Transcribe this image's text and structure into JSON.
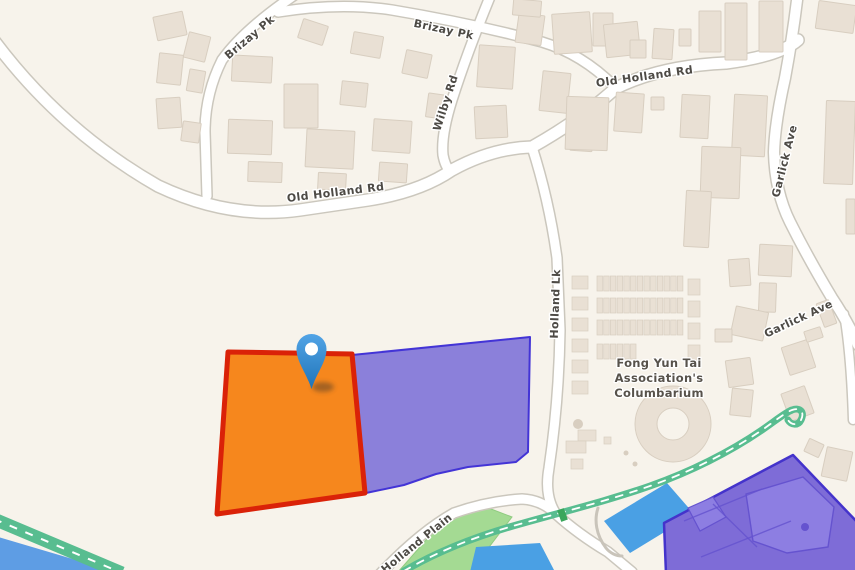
{
  "map": {
    "colors": {
      "bg": "#f7f3eb",
      "building_fill": "#e9e0d4",
      "building_stroke": "#d8cec0",
      "road_casing": "#cbc7bd",
      "road_fill": "#ffffff",
      "road_label": "#4d4a45",
      "poi_label": "#57524b",
      "park_fill": "#a4da93",
      "park_stroke": "#8fcb80",
      "water": "#5e9de4",
      "pond": "#4aa0e4",
      "path_green": "#58bd90",
      "path_dash": "#ffffff",
      "path_marker": "#3aa65c",
      "selected_fill": "#f6871d",
      "selected_stroke": "#da2208",
      "adjacent_fill": "#8b80da",
      "adjacent_stroke": "#4334d6",
      "estate_fill": "#7e6cd7",
      "estate_stroke": "#4433cb",
      "estate_inner_fill": "#8d7ee2",
      "estate_inner_line": "#6553cf",
      "pin_top": "#52a4e6",
      "pin_bottom": "#1f74b8",
      "pin_hole": "#ffffff",
      "wall_gray": "#c9c4ba"
    },
    "road_labels": [
      {
        "text": "Brizay Pk",
        "x": 252,
        "y": 40,
        "rotate": -40
      },
      {
        "text": "Brizay Pk",
        "x": 443,
        "y": 33,
        "rotate": 12
      },
      {
        "text": "Wilby Rd",
        "x": 449,
        "y": 104,
        "rotate": -72
      },
      {
        "text": "Old Holland Rd",
        "x": 336,
        "y": 196,
        "rotate": -7
      },
      {
        "text": "Old Holland Rd",
        "x": 645,
        "y": 80,
        "rotate": -8
      },
      {
        "text": "Holland Lk",
        "x": 559,
        "y": 304,
        "rotate": -88
      },
      {
        "text": "Garlick Ave",
        "x": 788,
        "y": 162,
        "rotate": -76
      },
      {
        "text": "Garlick Ave",
        "x": 800,
        "y": 322,
        "rotate": -25
      },
      {
        "text": "Holland Plain",
        "x": 419,
        "y": 546,
        "rotate": -39
      }
    ],
    "poi_label": {
      "lines": [
        "Fong Yun Tai",
        "Association's",
        "Columbarium"
      ],
      "x": 659,
      "y": 367,
      "line_height": 15
    },
    "roads": [
      {
        "name": "old-holland-rd",
        "d": "M -8 38 Q 60 130 158 186 Q 230 220 300 210 L 368 200 Q 420 192 452 170 Q 492 148 532 147 Q 580 120 616 88 Q 660 66 726 63 Q 780 56 798 40",
        "w": 11,
        "cw": 14
      },
      {
        "name": "brizay-pk-south",
        "d": "M 299 -8 Q 245 28 222 60 Q 205 94 205 132 L 207 196",
        "w": 9,
        "cw": 12
      },
      {
        "name": "brizay-pk-east",
        "d": "M 278 12 Q 340 2 392 10 Q 470 23 542 42 Q 582 54 614 86",
        "w": 9,
        "cw": 12
      },
      {
        "name": "wilby-rd",
        "d": "M 492 -8 Q 468 50 452 100 Q 441 135 443 155 Q 445 166 450 171",
        "w": 9,
        "cw": 12
      },
      {
        "name": "holland-lk",
        "d": "M 532 147 Q 549 200 557 258 L 560 330 Q 559 400 549 468 Q 544 496 556 514 Q 578 534 608 552 L 632 572",
        "w": 9,
        "cw": 12
      },
      {
        "name": "holland-plain",
        "d": "M 380 574 Q 420 532 454 513 Q 488 501 522 499 Q 542 500 556 514",
        "w": 9,
        "cw": 12
      },
      {
        "name": "garlick-ave",
        "d": "M 798 -8 Q 793 35 785 78 Q 775 122 774 152 Q 775 192 790 222 Q 808 258 832 298 Q 848 322 858 345",
        "w": 10,
        "cw": 13
      },
      {
        "name": "garlick-stub",
        "d": "M 844 314 Q 851 355 853 420",
        "w": 8,
        "cw": 11
      }
    ],
    "water": {
      "points": "-5,536 120,573 -5,573"
    },
    "park": {
      "points": "398,572 448,515 478,504 512,517 470,572"
    },
    "ponds": [
      {
        "points": "604,521 667,483 694,514 630,553"
      },
      {
        "points": "476,547 540,543 554,570 470,572"
      }
    ],
    "green_band": {
      "d": "M -6 519 L 122 573"
    },
    "green_path": {
      "d": "M 404 571 C 440 550 480 535 520 524 C 570 510 610 500 650 486 C 690 472 730 452 762 430 C 775 421 786 412 792 410 C 800 407 805 412 801 420 C 798 426 791 425 788 420"
    },
    "path_marker": {
      "x": 559,
      "y": 509,
      "w": 7,
      "h": 12,
      "rotate": -20
    },
    "wall": {
      "d": "M 598 508 C 594 520 596 535 606 548 C 610 553 616 556 622 556"
    },
    "parcels": {
      "selected": {
        "points": "228,352 352,354 365,493 217,514"
      },
      "adjacent": {
        "points": "352,355 530,337 528,452 516,462 468,467 436,474 404,485 366,493"
      },
      "estate": {
        "points": "793,455 858,523 858,574 666,574 664,523",
        "inner_big": "746,494 803,477 834,507 828,547 787,553 753,541",
        "inner_wedge": "688,508 713,497 726,517 700,531",
        "inner_lines": [
          [
            684,
            521,
            762,
            489
          ],
          [
            701,
            557,
            791,
            521
          ],
          [
            713,
            504,
            757,
            547
          ]
        ],
        "dot": [
          805,
          527,
          4
        ]
      }
    },
    "pin": {
      "cx": 311.5,
      "cy": 349,
      "tip_y": 389,
      "r": 15,
      "hole_r": 6.5,
      "shadow": [
        323,
        387,
        11,
        5
      ]
    },
    "buildings": [
      [
        155,
        14,
        30,
        24,
        -12
      ],
      [
        186,
        34,
        22,
        26,
        14
      ],
      [
        158,
        54,
        24,
        30,
        6
      ],
      [
        188,
        70,
        16,
        22,
        10
      ],
      [
        157,
        98,
        24,
        30,
        -4
      ],
      [
        182,
        122,
        18,
        20,
        8
      ],
      [
        300,
        22,
        26,
        20,
        18
      ],
      [
        352,
        34,
        30,
        22,
        10
      ],
      [
        404,
        52,
        26,
        24,
        12
      ],
      [
        232,
        56,
        40,
        26,
        3
      ],
      [
        284,
        84,
        34,
        44,
        0
      ],
      [
        341,
        82,
        26,
        24,
        6
      ],
      [
        228,
        120,
        44,
        34,
        2
      ],
      [
        306,
        130,
        48,
        38,
        3
      ],
      [
        373,
        120,
        38,
        32,
        4
      ],
      [
        248,
        162,
        34,
        20,
        2
      ],
      [
        318,
        173,
        28,
        17,
        3
      ],
      [
        379,
        163,
        28,
        19,
        4
      ],
      [
        427,
        94,
        18,
        24,
        8
      ],
      [
        478,
        46,
        36,
        42,
        4
      ],
      [
        517,
        14,
        26,
        30,
        8
      ],
      [
        541,
        72,
        28,
        40,
        6
      ],
      [
        475,
        106,
        32,
        32,
        -3
      ],
      [
        571,
        119,
        22,
        32,
        4
      ],
      [
        513,
        0,
        28,
        16,
        5
      ],
      [
        553,
        13,
        38,
        40,
        -4
      ],
      [
        593,
        13,
        20,
        33,
        0
      ],
      [
        605,
        23,
        34,
        33,
        -6
      ],
      [
        630,
        40,
        16,
        18,
        0
      ],
      [
        653,
        29,
        20,
        30,
        4
      ],
      [
        679,
        29,
        12,
        17,
        0
      ],
      [
        699,
        11,
        22,
        41,
        0
      ],
      [
        725,
        3,
        22,
        57,
        0
      ],
      [
        759,
        1,
        24,
        51,
        0
      ],
      [
        817,
        3,
        38,
        28,
        8
      ],
      [
        566,
        97,
        42,
        53,
        2
      ],
      [
        615,
        93,
        28,
        39,
        4
      ],
      [
        651,
        97,
        13,
        13,
        0
      ],
      [
        681,
        95,
        28,
        43,
        3
      ],
      [
        733,
        95,
        33,
        61,
        3
      ],
      [
        701,
        147,
        39,
        51,
        2
      ],
      [
        685,
        191,
        25,
        56,
        3
      ],
      [
        825,
        101,
        29,
        83,
        2
      ],
      [
        846,
        199,
        9,
        35,
        0
      ],
      [
        759,
        245,
        33,
        31,
        3
      ],
      [
        729,
        259,
        21,
        27,
        -4
      ],
      [
        759,
        283,
        17,
        29,
        2
      ],
      [
        733,
        309,
        33,
        29,
        12
      ],
      [
        715,
        329,
        17,
        13,
        0
      ],
      [
        727,
        359,
        25,
        27,
        -8
      ],
      [
        785,
        343,
        27,
        29,
        -18
      ],
      [
        805,
        329,
        17,
        11,
        -18
      ],
      [
        731,
        389,
        21,
        27,
        6
      ],
      [
        785,
        389,
        25,
        29,
        -20
      ],
      [
        820,
        301,
        13,
        25,
        -20
      ],
      [
        824,
        449,
        26,
        30,
        12
      ],
      [
        806,
        441,
        16,
        14,
        25
      ]
    ],
    "columbarium": {
      "grid_rows": [
        {
          "x": 597,
          "y": 276,
          "cols": 13,
          "cw": 5.5,
          "gap": 1.2,
          "h": 15
        },
        {
          "x": 597,
          "y": 298,
          "cols": 13,
          "cw": 5.5,
          "gap": 1.2,
          "h": 15
        },
        {
          "x": 597,
          "y": 320,
          "cols": 13,
          "cw": 5.5,
          "gap": 1.2,
          "h": 15
        },
        {
          "x": 597,
          "y": 344,
          "cols": 6,
          "cw": 5.5,
          "gap": 1.2,
          "h": 15
        }
      ],
      "left_stack": {
        "x": 572,
        "y": 276,
        "w": 16,
        "h": 13,
        "step": 21,
        "count": 6
      },
      "right_stack": {
        "x": 688,
        "y": 279,
        "w": 12,
        "h": 16,
        "step": 22,
        "count": 4
      },
      "extras": [
        [
          578,
          430,
          18,
          11
        ],
        [
          604,
          437,
          7,
          7
        ],
        [
          566,
          441,
          20,
          12
        ],
        [
          571,
          459,
          12,
          10
        ]
      ],
      "dots": [
        [
          578,
          424,
          5
        ],
        [
          626,
          453,
          2.5
        ],
        [
          635,
          464,
          2.5
        ]
      ],
      "ring": {
        "cx": 673,
        "cy": 424,
        "ro": 38,
        "ri": 16
      }
    }
  }
}
